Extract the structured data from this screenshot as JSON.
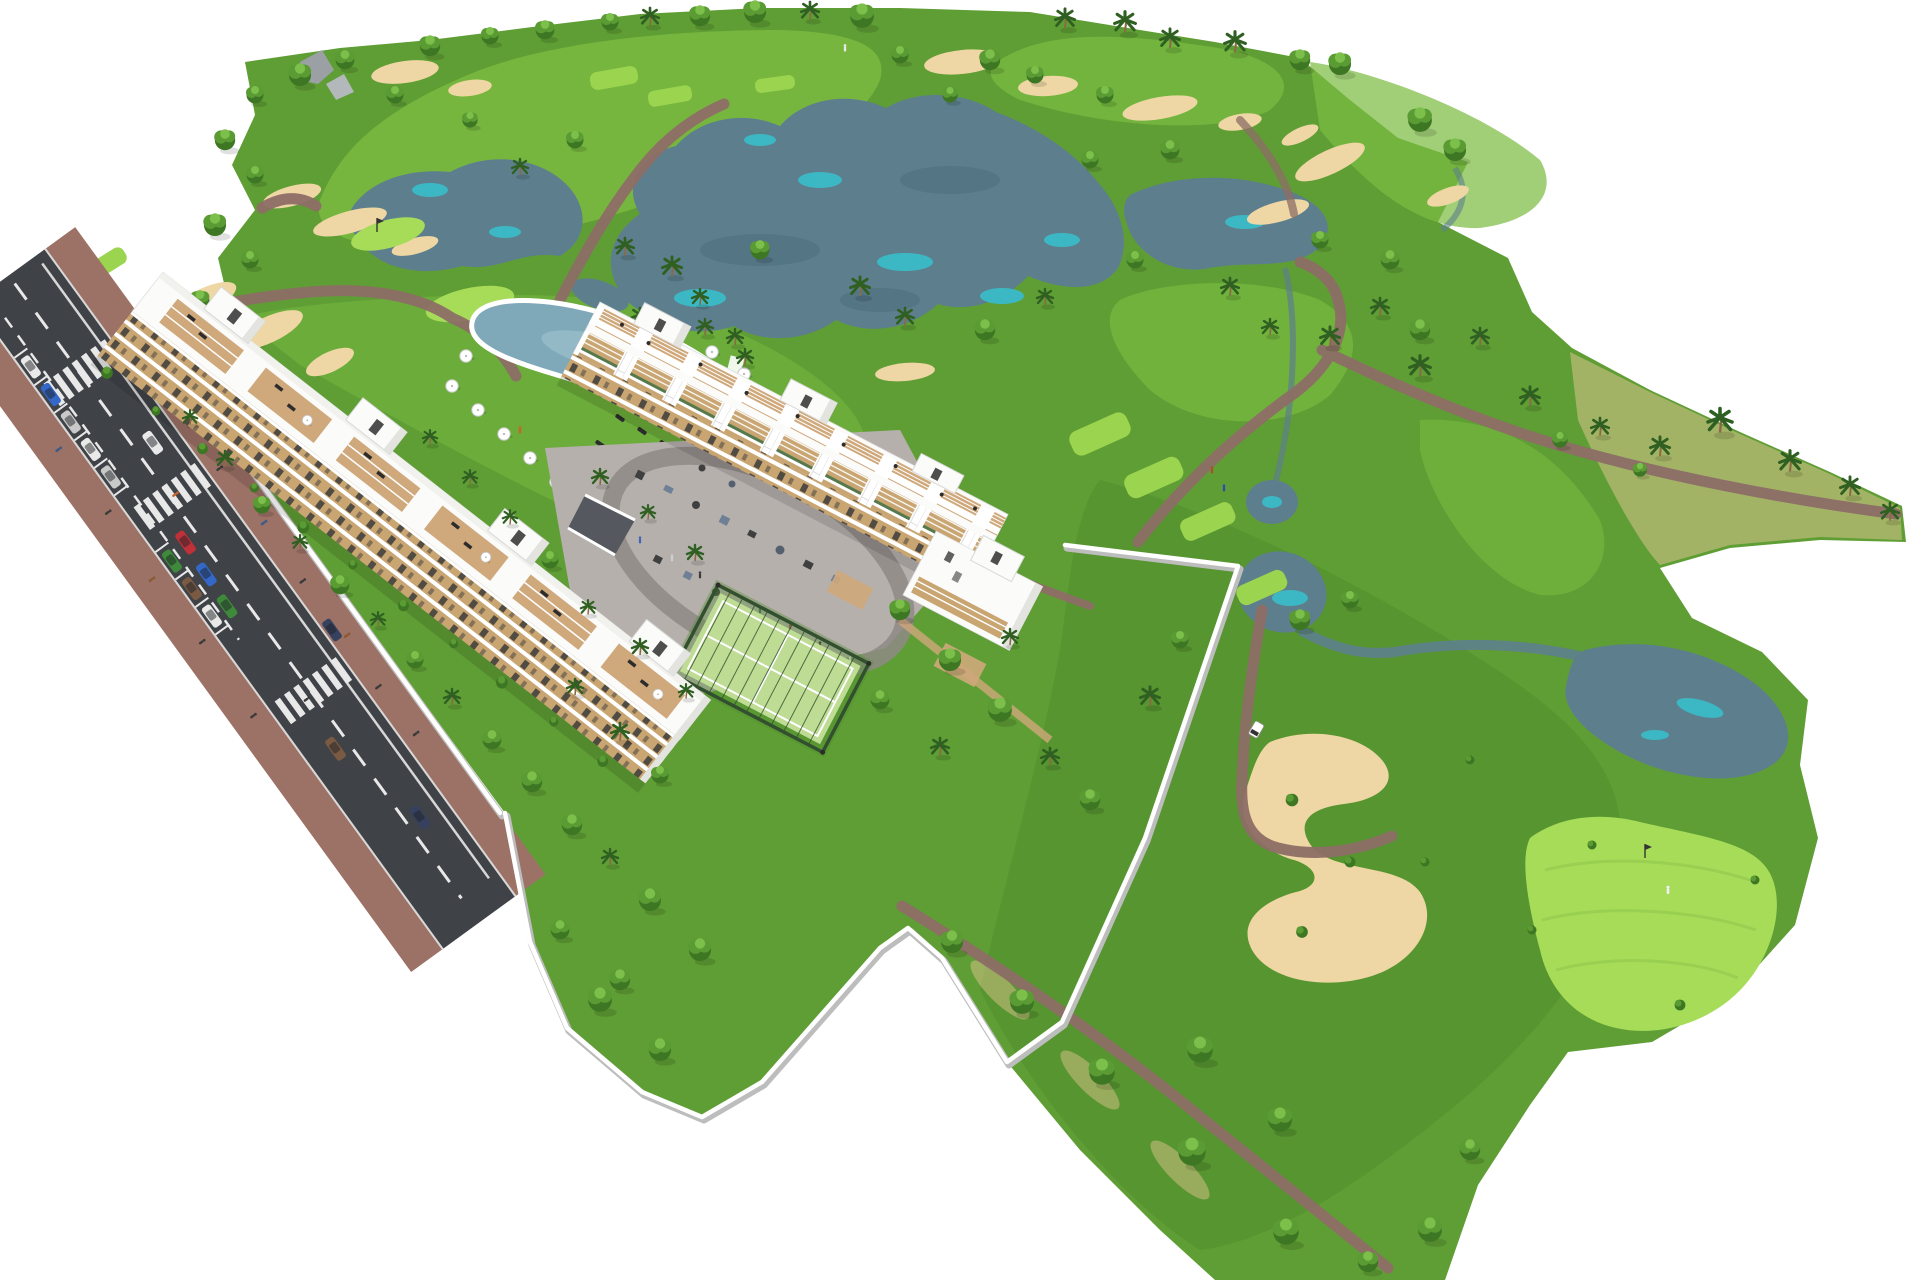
{
  "scene": {
    "description": "Aerial 3D architectural rendering of a golf-resort residential development: two long white apartment buildings with rooftop terraces, communal kidney-shaped pool with white parasols and sun loungers, central playground courtyard, fenced padel court, walled private gardens, an access road with parked and moving cars, and a surrounding golf course with lakes, sand bunkers, cart paths, palm trees, a golf cart and a golfer beside a pin flag on a putting green. White background around the irregular terrain silhouette.",
    "elements": [
      "golf-course-terrain",
      "main-lake",
      "left-lake",
      "right-lake",
      "bottom-right-lake",
      "sand-bunkers",
      "s-shaped-bunker",
      "cart-path-network",
      "tee-boxes",
      "putting-greens",
      "tree-rows",
      "palm-rows",
      "rock-outcrop",
      "access-road",
      "crosswalks",
      "parked-cars",
      "moving-cars",
      "sidewalk-pedestrians",
      "perimeter-walls",
      "apartment-building-a",
      "apartment-building-b",
      "stair-towers",
      "rooftop-terraces",
      "swimming-pool",
      "pool-parasols",
      "sun-loungers",
      "playground-courtyard",
      "play-equipment",
      "padel-court",
      "garage-ramp",
      "golf-cart",
      "golfer",
      "pin-flags",
      "garden-trees"
    ]
  },
  "palette": {
    "bg": "#ffffff",
    "grass": "#5f9e35",
    "grassDark": "#4c8a2a",
    "grassLight": "#7cbd42",
    "tee": "#9bd44f",
    "green2": "#a6dc58",
    "lake": "#5d7f8d",
    "lakeTeal": "#3cb8c4",
    "lakeDark": "#476b7a",
    "sand": "#eed7a4",
    "sandDark": "#dbc48e",
    "path": "#8d6e66",
    "road": "#3f4247",
    "roadLine": "#e8e8e8",
    "sidewalk": "#9c7166",
    "wall": "#ffffff",
    "wallShadow": "#bdbdbd",
    "bld": "#fbfbfa",
    "bldShade": "#e3e3df",
    "bldDark": "#cfcfca",
    "tan": "#c9a572",
    "tanDeck": "#cfa87b",
    "win": "#3b3b3b",
    "tree1": "#3e7724",
    "tree2": "#5a9c33",
    "tree3": "#7cbf4a",
    "palm": "#2f6022",
    "trunk": "#8a6a45",
    "hedge": "#39622d",
    "padel": "#bedc93",
    "padelFence": "#32502f",
    "pave": "#b5b0ac",
    "paveDark": "#8f8a86",
    "pool": "#7fa9b9",
    "poolLight": "#a3c6cf",
    "rock": "#9aa0a3",
    "carWhite": "#e9e9e9",
    "carBlue": "#3468c8",
    "carRed": "#c03038",
    "carGreen": "#3f8a3a",
    "carSilver": "#c9c9c9",
    "carDark": "#35415e",
    "carBrown": "#7a5a42",
    "people": "#3a3a3a"
  }
}
